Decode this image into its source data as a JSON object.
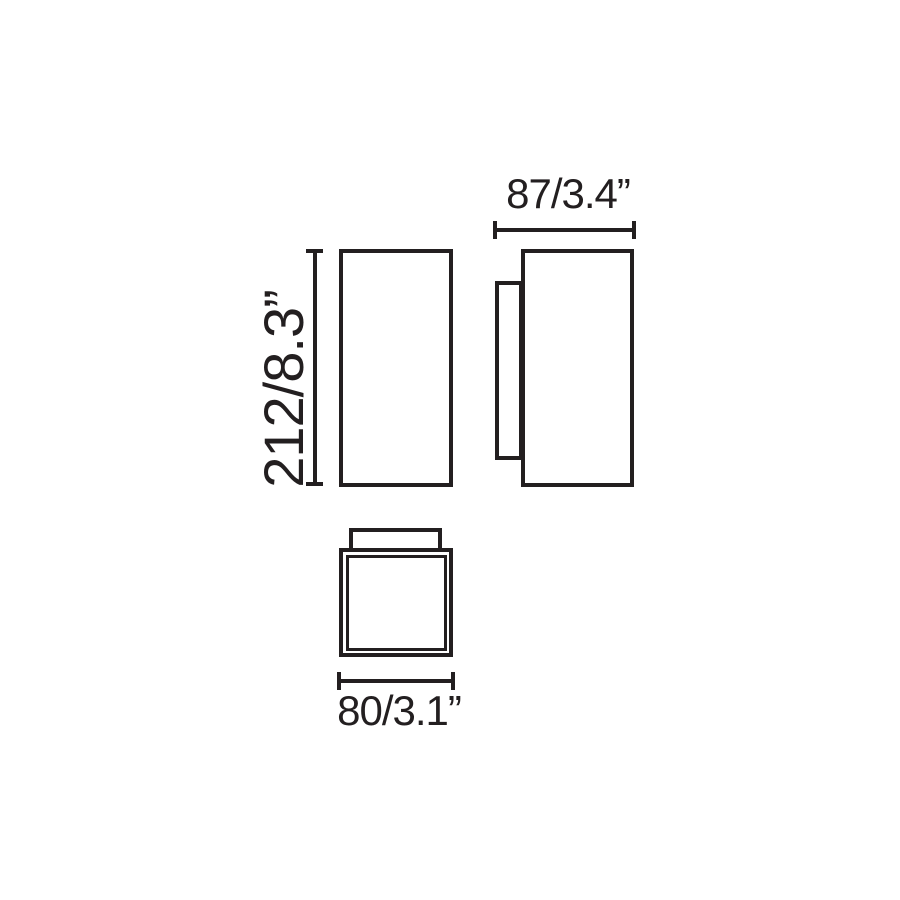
{
  "page": {
    "background_color": "#ffffff",
    "line_color": "#231f20"
  },
  "drawing": {
    "type": "technical-dimension-diagram",
    "dimensions": {
      "height": {
        "label": "212/8.3”",
        "mm": 212,
        "inches": 8.3
      },
      "depth": {
        "label": "87/3.4”",
        "mm": 87,
        "inches": 3.4
      },
      "width": {
        "label": "80/3.1”",
        "mm": 80,
        "inches": 3.1
      }
    }
  }
}
